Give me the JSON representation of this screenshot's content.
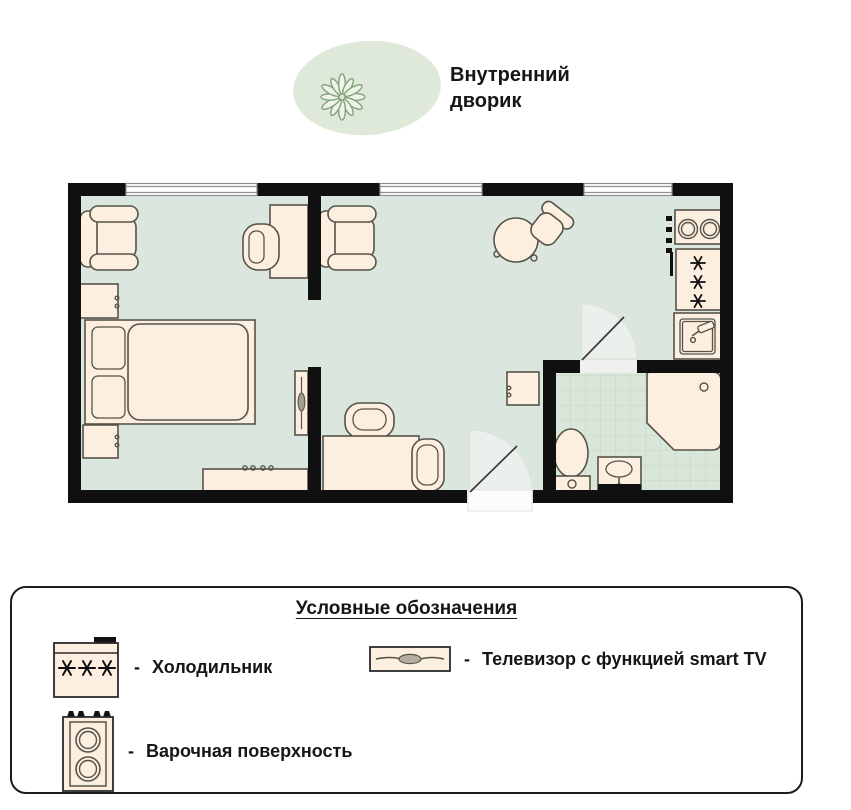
{
  "courtyard": {
    "label_line1": "Внутренний",
    "label_line2": "дворик",
    "icon": "plant-sketch-icon"
  },
  "floor_plan": {
    "rooms": [
      "спальня",
      "гостиная",
      "кухня",
      "санузел"
    ],
    "furniture_icons": [
      "armchair-icon",
      "bed-icon",
      "nightstand-icon",
      "desk-icon",
      "chair-icon",
      "tv-icon",
      "dresser-icon",
      "sofa-table-icon",
      "lounge-chair-icon",
      "round-table-icon",
      "cabinet-icon",
      "stove-icon",
      "refrigerator-icon",
      "kitchen-sink-icon",
      "shower-icon",
      "toilet-icon",
      "washbasin-icon",
      "door-swing-icon",
      "window-icon"
    ],
    "palette": {
      "floor": "#dbe7de",
      "tile": "#d9e6da",
      "furniture": "#fcefdf",
      "walls": "#101010",
      "courtyard_blob": "#dfe9da",
      "plant_stroke": "#7fa377"
    }
  },
  "legend": {
    "title": "Условные обозначения",
    "dash": "-",
    "items": [
      {
        "icon": "refrigerator-icon",
        "label": "Холодильник"
      },
      {
        "icon": "cooktop-icon",
        "label": "Варочная поверхность"
      },
      {
        "icon": "smart-tv-icon",
        "label": "Телевизор с функцией smart TV"
      }
    ]
  }
}
